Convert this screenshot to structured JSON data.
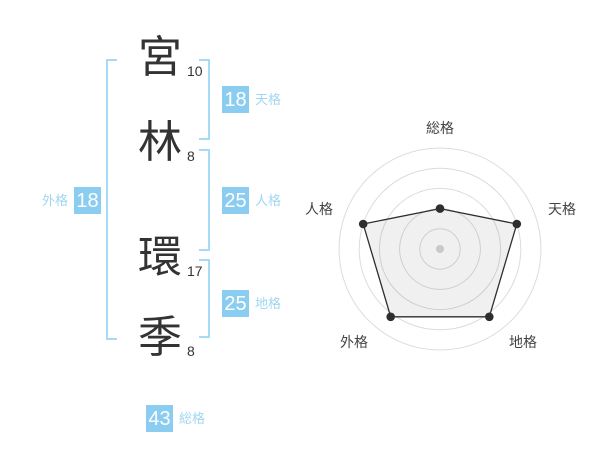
{
  "name_diagram": {
    "characters": [
      {
        "char": "宮",
        "strokes": "10"
      },
      {
        "char": "林",
        "strokes": "8"
      },
      {
        "char": "環",
        "strokes": "17"
      },
      {
        "char": "季",
        "strokes": "8"
      }
    ],
    "badges": {
      "tenkaku": {
        "value": "18",
        "label": "天格"
      },
      "jinkaku": {
        "value": "25",
        "label": "人格"
      },
      "chikaku": {
        "value": "25",
        "label": "地格"
      },
      "gaikaku": {
        "value": "18",
        "label": "外格"
      },
      "soukaku": {
        "value": "43",
        "label": "総格"
      }
    }
  },
  "chart_data": {
    "type": "radar",
    "axes": [
      "総格",
      "天格",
      "地格",
      "外格",
      "人格"
    ],
    "values": [
      40,
      80,
      83,
      83,
      80
    ],
    "max": 100,
    "rings": [
      20,
      40,
      60,
      80,
      100
    ],
    "title": "",
    "legend": "none",
    "grid": "circular"
  },
  "colors": {
    "accent_blue": "#8bcdf0",
    "label_blue": "#a0d6f2",
    "bracket_blue": "#a6daf5",
    "text_dark": "#333333",
    "radar_grid": "#dcdcdc",
    "radar_line": "#2e2e2e",
    "radar_fill": "rgba(0,0,0,0.06)",
    "radar_marker": "#2e2e2e",
    "radar_center_dot": "#c9c9c9",
    "radar_label": "#444444"
  }
}
